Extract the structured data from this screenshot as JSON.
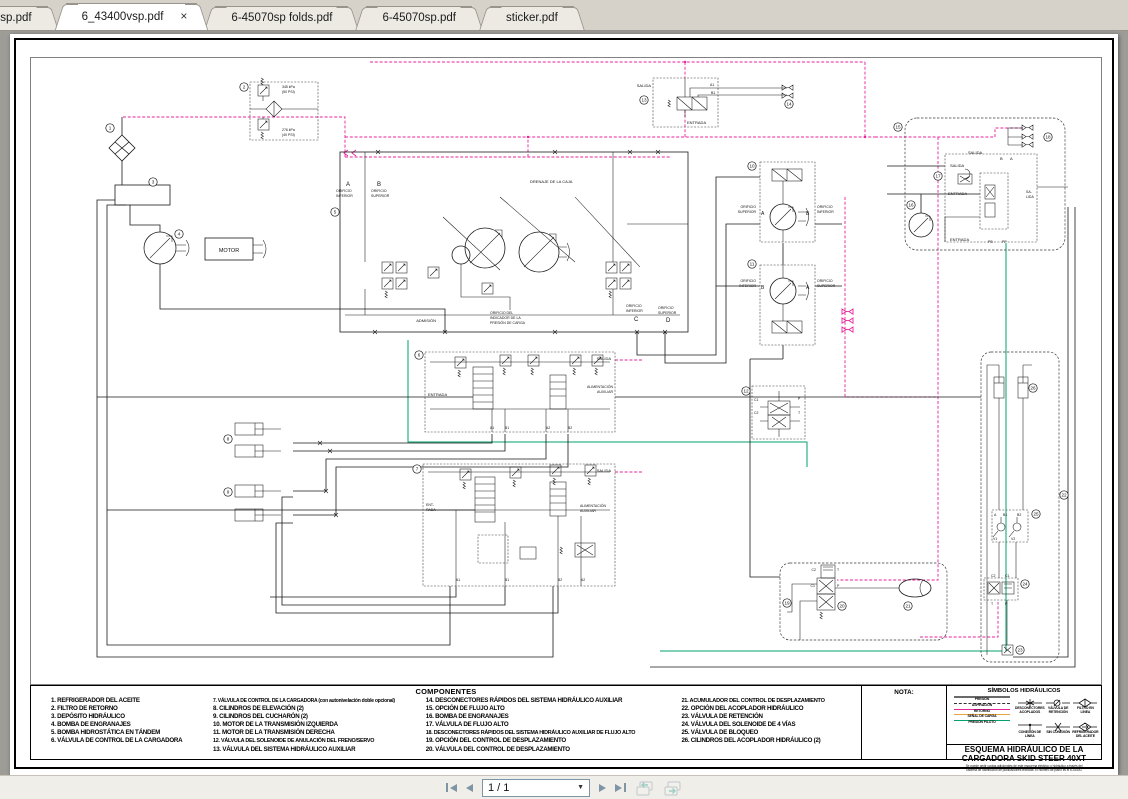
{
  "tabs": [
    {
      "label": "0rsp.pdf"
    },
    {
      "label": "6_43400vsp.pdf"
    },
    {
      "label": "6-45070sp folds.pdf"
    },
    {
      "label": "6-45070sp.pdf"
    },
    {
      "label": "sticker.pdf"
    }
  ],
  "tab_close": "×",
  "toolbar": {
    "page_indicator": "1 / 1"
  },
  "colors": {
    "pressure_line": "#e8249c",
    "pilot_line": "#00a36a",
    "signal_line": "#e8a33d",
    "ink": "#1a1a1a"
  },
  "dg": {
    "motor": "MOTOR",
    "salida": "SALIDA",
    "entrada": "ENTRADA",
    "ent1": "ENT-",
    "ent2": "RADA",
    "sal1": "SA-",
    "sal2": "LIDA",
    "admision": "ADMISIÓN",
    "drenaje": "DRENAJE DE LA CAJA",
    "orificio": "ORIFICIO",
    "superior": "SUPERIOR",
    "inferior": "INFERIOR",
    "ind1": "ORIFICIO DEL",
    "ind2": "INDICADOR DE LA",
    "ind3": "PRESIÓN DE CARGA",
    "alim1": "ALIMENTACIÓN",
    "alim2": "AUXILIAR",
    "p50a": "345 kPa",
    "p50b": "(50 PSI)",
    "p40a": "276 kPa",
    "p40b": "(40 PSI)",
    "a": "A",
    "b": "B",
    "c": "C",
    "d": "D",
    "a1": "A1",
    "b1": "B1",
    "a2": "A2",
    "b2": "B2",
    "v1": "V1",
    "v2": "V2",
    "c1": "C1",
    "c2": "C2",
    "p": "P",
    "t": "T",
    "pb": "PB",
    "pp": "PP"
  },
  "mk": {
    "m1": "1",
    "m2": "2",
    "m3": "3",
    "m4": "4",
    "m5": "5",
    "m6": "6",
    "m7": "7",
    "m8": "8",
    "m9": "9",
    "m10": "10",
    "m11": "11",
    "m12": "12",
    "m13": "13",
    "m14": "14",
    "m15": "15",
    "m16": "16",
    "m17": "17",
    "m18": "18",
    "m19": "19",
    "m20": "20",
    "m21": "21",
    "m22": "22",
    "m23": "23",
    "m24": "24",
    "m25": "25",
    "m26": "26"
  },
  "components": {
    "title": "COMPONENTES",
    "col1": [
      "1. REFRIGERADOR DEL ACEITE",
      "2. FILTRO DE RETORNO",
      "3. DEPÓSITO HIDRÁULICO",
      "4. BOMBA DE ENGRANAJES",
      "5. BOMBA HIDROSTÁTICA EN TÁNDEM",
      "6. VÁLVULA DE CONTROL DE LA CARGADORA"
    ],
    "col2": [
      "7. VÁLVULA DE CONTROL DE LA CARGADORA (con autonivelación doble opcional)",
      "8. CILINDROS DE ELEVACIÓN (2)",
      "9. CILINDROS DEL CUCHARÓN (2)",
      "10. MOTOR DE LA TRANSMISIÓN IZQUIERDA",
      "11. MOTOR DE LA TRANSMISIÓN DERECHA",
      "12. VÁLVULA DEL SOLENOIDE DE ANULACIÓN DEL FRENO/SERVO",
      "13. VÁLVULA DEL SISTEMA HIDRÁULICO AUXILIAR"
    ],
    "col3": [
      "14. DESCONECTORES RÁPIDOS DEL SISTEMA HIDRÁULICO AUXILIAR",
      "15. OPCIÓN DE FLUJO ALTO",
      "16. BOMBA DE ENGRANAJES",
      "17. VÁLVULA DE FLUJO ALTO",
      "18. DESCONECTORES RÁPIDOS DEL SISTEMA HIDRÁULICO AUXILIAR DE FLUJO ALTO",
      "19. OPCIÓN DEL CONTROL DE DESPLAZAMIENTO",
      "20. VÁLVULA DEL CONTROL DE DESPLAZAMIENTO"
    ],
    "col4": [
      "21. ACUMULADOR DEL CONTROL DE DESPLAZAMIENTO",
      "22. OPCIÓN DEL ACOPLADOR HIDRÁULICO",
      "23. VÁLVULA DE RETENCIÓN",
      "24. VÁLVULA DEL SOLENOIDE DE 4 VÍAS",
      "25. VÁLVULA DE BLOQUEO",
      "26. CILINDROS DEL ACOPLADOR HIDRÁULICO (2)"
    ]
  },
  "nota": "NOTA:",
  "legend": {
    "title": "SÍMBOLOS HIDRÁULICOS",
    "lines": [
      {
        "label": "PRESIÓN"
      },
      {
        "label": "ASPIRACIÓN"
      },
      {
        "label": "RETORNO"
      },
      {
        "label": "SEÑAL DE CARGA"
      },
      {
        "label": "PRESIÓN PILOTO"
      }
    ],
    "symbols": [
      {
        "label": "DESCONECTORES ACOPLADOS"
      },
      {
        "label": "VÁLVULA DE RETENCIÓN"
      },
      {
        "label": "FILTRO EN LÍNEA"
      },
      {
        "label": "CONEXIÓN DE LÍNEA"
      },
      {
        "label": "SIN CONEXIÓN"
      },
      {
        "label": "REFRIGERADOR DEL ACEITE"
      }
    ]
  },
  "titleblock": {
    "line1": "ESQUEMA HIDRÁULICO DE LA",
    "line2": "CARGADORA SKID STEER 40XT",
    "fine1": "Se puede pedir copias adicionales de este esquema eléctrico o hidráulico a través del",
    "fine2": "Sistema de distribución de publicaciones técnicas. El número de plano es el 6-43400."
  }
}
